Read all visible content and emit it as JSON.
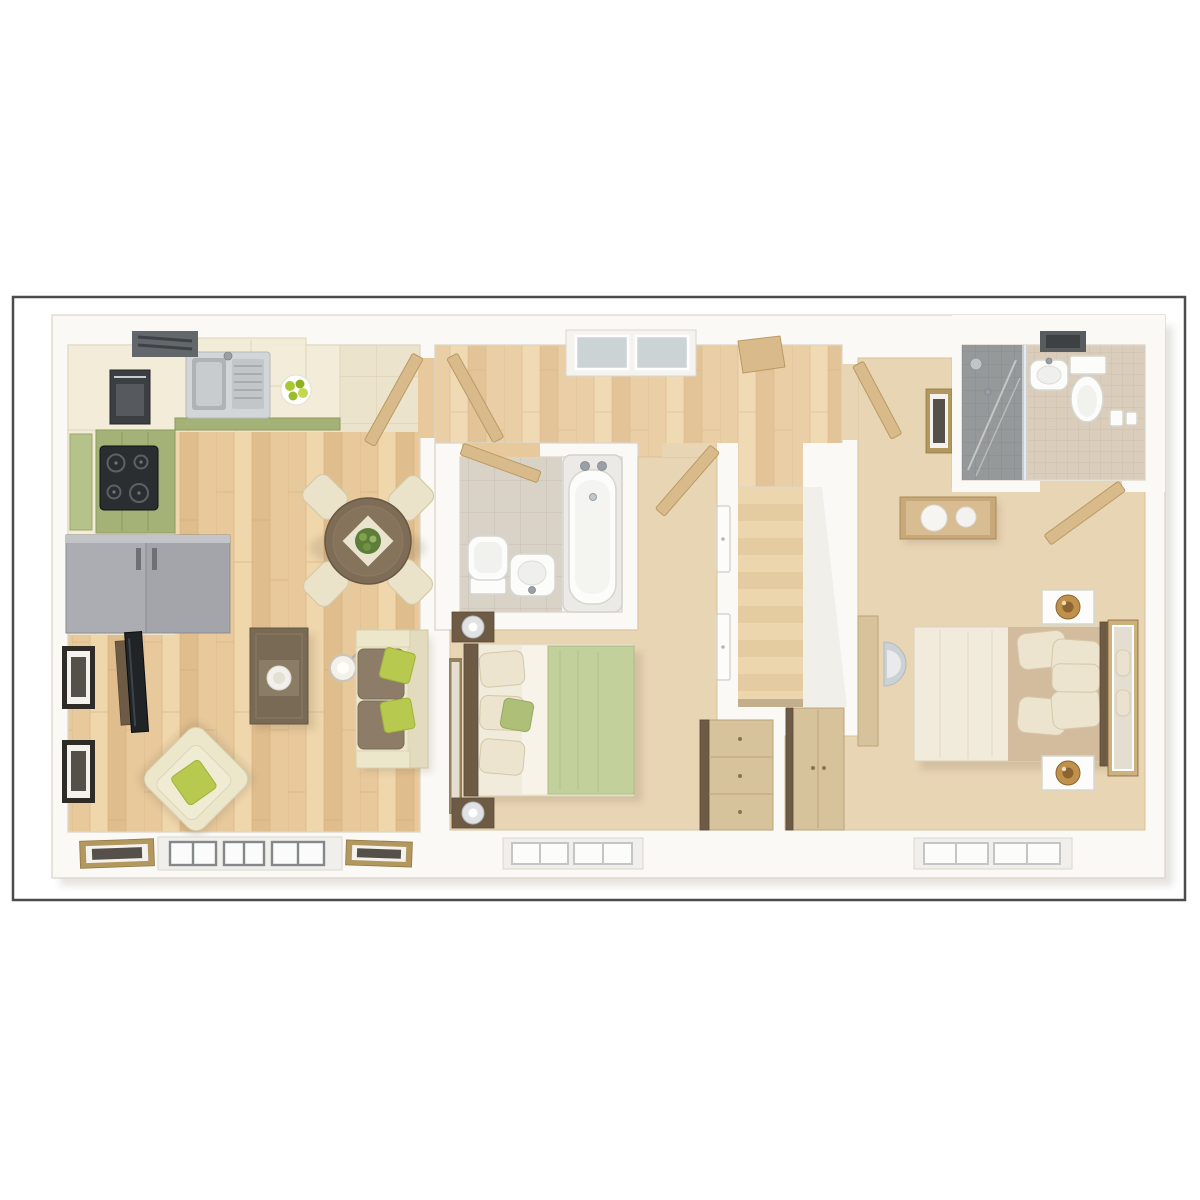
{
  "image": {
    "type": "3d-floor-plan",
    "label": "Top-down 3D render of a floor plan with open-plan kitchen/dining/living room, landing with staircase, family bathroom, two double bedrooms and an en-suite shower room",
    "visible_text": []
  },
  "palette": {
    "page_bg": "#ffffff",
    "frame_border": "#4b4b4b",
    "wall": "#faf9f5",
    "wall_edge": "#dbd6cc",
    "shadow_c": "rgba(80,68,45,0.14)",
    "wood_a": "#e8c99c",
    "wood_b": "#e0bd8d",
    "wood_c": "#efd6ab",
    "plank_line": "#d2ad7c",
    "stone": "#ece3cc",
    "stone_line": "#ded2b5",
    "carpet": "#e8d5b4",
    "carpet_edge": "#d8c29e",
    "tile_gray": "#d8d2c7",
    "tile_gray_line": "#c8c0b2",
    "tile_beige": "#dacdbb",
    "tile_beige_line": "#c9baa3",
    "shower_gray": "#95999a",
    "shower_line": "#85898a",
    "glass": "#ccd3d5",
    "white_fix": "#fcfcfb",
    "fix_edge": "#d6d6d0",
    "chrome": "#9aa0a5",
    "green_cab": "#a5b277",
    "green_cab_dark": "#8c9a5d",
    "cream_counter": "#f2ecd8",
    "cream_edge": "#ded5ba",
    "grey_unit": "#a4a5aa",
    "dark_appl": "#2b2e30",
    "table_wood": "#7e6c56",
    "table_wood_edge": "#675843",
    "chair_cream": "#ebe3c9",
    "chair_edge": "#d4c9a8",
    "sofa_cream": "#ece6cb",
    "sofa_edge": "#d7cfad",
    "seat_brown": "#8d7d68",
    "seat_brown_edge": "#796b57",
    "green_cushion": "#b7c94f",
    "green_cushion_edge": "#a0b23a",
    "dark_wood": "#6e5b46",
    "mid_wood": "#d6c29b",
    "mid_wood_edge": "#bba47a",
    "door_wood": "#d9bb8b",
    "door_wood_edge": "#b99a64",
    "stair_a": "#ecd6ae",
    "stair_b": "#e4cba0",
    "stair_line": "#caa揃e83",
    "bed_cream": "#f1ebdc",
    "bed_edge": "#ddd2b8",
    "sheet": "#f7f3e8",
    "pillow": "#ece4cf",
    "pillow_edge": "#d5c7a8",
    "duvet_green": "#c2d09b",
    "duvet_green_edge": "#adbc84",
    "tan": "#d2bc9d",
    "gold": "#c0914a",
    "gold_dark": "#8a6531",
    "mirror_frame": "#cbb17e",
    "mirror_glass": "#e4ded1",
    "frame_dark": "#2f2b27",
    "frame_gold": "#b2975f",
    "art_dark": "#55504a",
    "window_recess": "#f0efeb",
    "window_dark": "#84888b",
    "window_light": "#c3c5c6",
    "lamp_crystal": "#e0e2e4"
  },
  "rooms": {
    "kitchen_living_dining": {
      "label": "Open-plan kitchen, dining and living room",
      "items": [
        "L-shaped kitchen counter",
        "sink with drainer",
        "four-ring hob",
        "built-in oven",
        "extractor hood",
        "grey fridge-freezer unit",
        "fruit bowl",
        "round dining table with plant centrepiece",
        "four dining chairs",
        "wall-mounted TV",
        "two framed wall pictures",
        "armchair with green cushion",
        "coffee table with tray",
        "floor lamp",
        "sofa with green cushions",
        "bay window",
        "two leaning picture frames"
      ]
    },
    "landing": {
      "label": "Landing with staircase",
      "items": [
        "staircase of 13 treads",
        "skylight window",
        "loft hatch",
        "door to kitchen",
        "door to bathroom",
        "doors to bedrooms"
      ]
    },
    "bathroom": {
      "label": "Family bathroom",
      "items": [
        "bath with twin taps",
        "toilet",
        "basin",
        "grey tiled floor"
      ]
    },
    "bedroom_2": {
      "label": "Bedroom 2",
      "items": [
        "double bed with green duvet",
        "two dark-wood bedside tables with lamps",
        "wall mirror",
        "built-in cupboard doors",
        "chest of drawers",
        "window"
      ]
    },
    "bedroom_1": {
      "label": "Master bedroom",
      "items": [
        "double bed with cream and tan bedding",
        "two bedside tables with gold lamps",
        "leaning framed mirror",
        "console table with two bowls",
        "desk with chair",
        "wardrobe",
        "framed picture",
        "window"
      ]
    },
    "en_suite": {
      "label": "En-suite shower room",
      "items": [
        "shower enclosure with glass screen",
        "basin",
        "toilet",
        "toilet-roll holders",
        "extractor vent"
      ]
    }
  }
}
